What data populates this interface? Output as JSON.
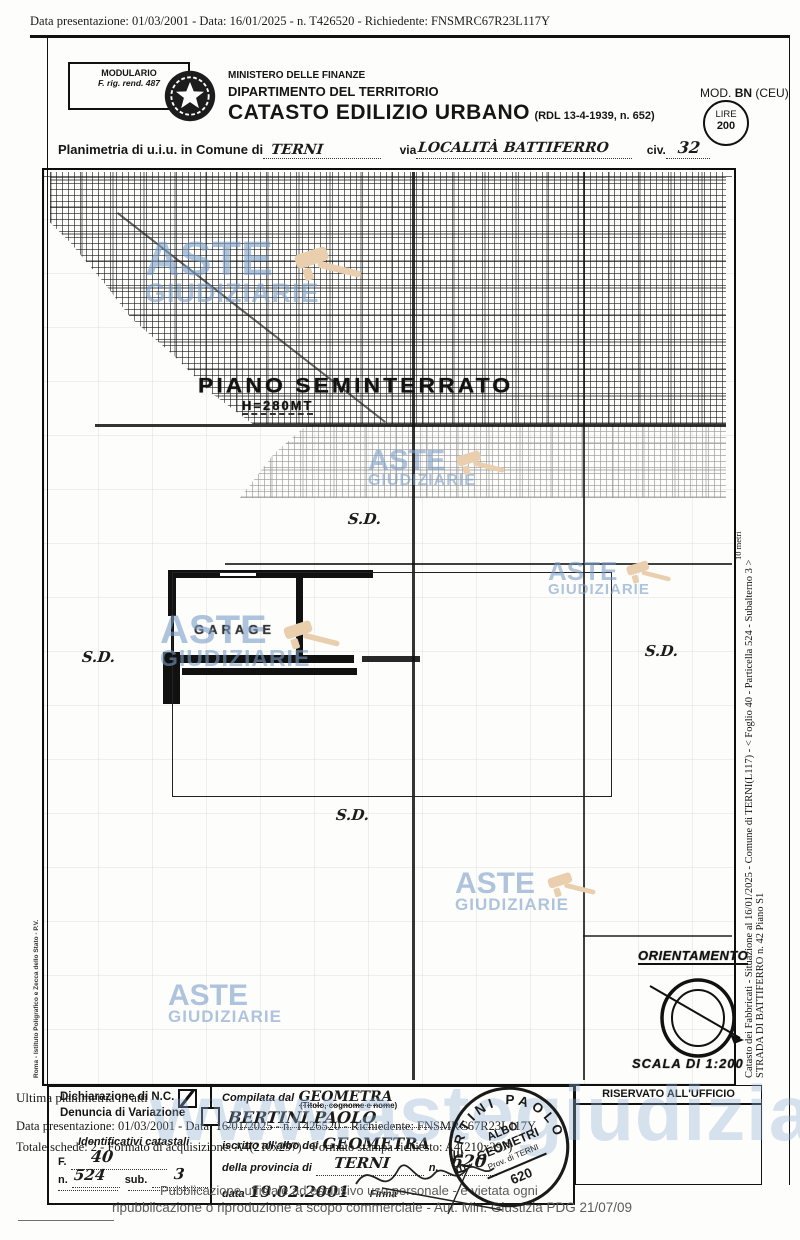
{
  "page": {
    "top_bar": "Data presentazione: 01/03/2001 - Data: 16/01/2025 - n. T426520 - Richiedente: FNSMRC67R23L117Y"
  },
  "watermark": {
    "line1": "ASTE",
    "line2": "GIUDIZIARIE",
    "site": "www.astegiudiziarie.it"
  },
  "header": {
    "modulario1": "MODULARIO",
    "modulario2": "F. rig. rend. 487",
    "ministry1": "MINISTERO DELLE FINANZE",
    "ministry2": "DIPARTIMENTO DEL TERRITORIO",
    "title": "CATASTO EDILIZIO URBANO",
    "title_suffix": "(RDL 13-4-1939, n. 652)",
    "mod_prefix": "MOD.",
    "mod_bold": "BN",
    "mod_suffix": "(CEU)",
    "lire_label": "LIRE",
    "lire_value": "200",
    "plan_prefix": "Planimetria di u.i.u. in Comune di",
    "comune_value": "TERNI",
    "via_label": "via",
    "via_value": "LOCALITÀ  BATTIFERRO",
    "civ_label": "civ.",
    "civ_value": "32"
  },
  "plan": {
    "floor_label": "PIANO SEMINTERRATO",
    "floor_height": "H=280MT",
    "room_label": "GARAGE",
    "sd": "S.D.",
    "orientation_label": "ORIENTAMENTO",
    "scale_label": "SCALA DI 1:200",
    "ruler_label": "10 metri",
    "right_note1": "Catasto dei Fabbricati - Situazione al 16/01/2025 - Comune di TERNI(L117) - < Foglio 40 - Particella 524 - Subalterno 3 >",
    "right_note2": "STRADA DI BATTIFERRO n. 42 Piano S1",
    "left_note": "Roma - Istituto Poligrafico e Zecca dello Stato - P.V."
  },
  "form": {
    "nc_label": "Dichiarazione di N.C.",
    "var_label": "Denuncia di  Variazione",
    "ident_title": "Identificativi catastali",
    "f_label": "F.",
    "f_value": "40",
    "n_label": "n.",
    "n_value": "524",
    "sub_label": "sub.",
    "sub_value": "3",
    "comp_prefix": "Compilata dal",
    "comp_value": "GEOMETRA",
    "comp_sub": "(Titolo, cognome e nome)",
    "comp_name": "BERTINI  PAOLO",
    "albo_prefix": "iscritto all'albo dei",
    "albo_value": "GEOMETRA",
    "prov_prefix": "della provincia di",
    "prov_value": "TERNI",
    "num_label": "n.",
    "num_value": "620",
    "date_label": "data",
    "date_value": "19.02.2001",
    "firma_label": "Firma",
    "stamp_outer": "BERTINI PAOLO",
    "stamp1": "ALBO",
    "stamp2": "GEOMETRI",
    "stamp3": "Prov. di TERNI",
    "stamp_num": "620",
    "reserved": "RISERVATO ALL'UFFICIO"
  },
  "overlay": {
    "ultima": "Ultima planimetria in atti",
    "data_line": "Data presentazione: 01/03/2001 - Data: 16/01/2025 - n. T426520 - Richiedente: FNSMRC67R23L117Y",
    "totale_line": "Totale schede: 2 - Formato di acquisizione: A4(210x297) - Formato stampa richiesto: A4(210x297)",
    "footer1": "Pubblicazione ufficiale ad esclusivo uso personale - è vietata ogni",
    "footer2": "ripubblicazione o riproduzione a scopo commerciale - Aut. Min. Giustizia PDG 21/07/09"
  }
}
